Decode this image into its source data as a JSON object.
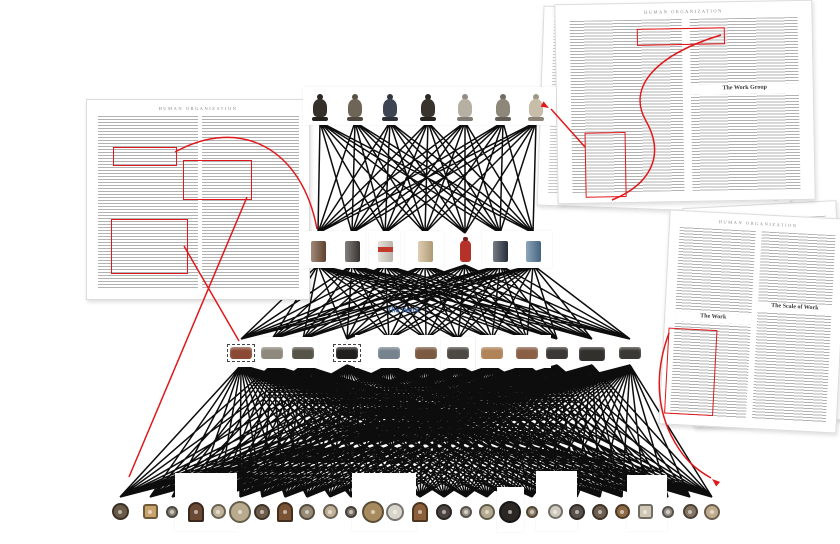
{
  "canvas": {
    "width": 840,
    "height": 544,
    "bg": "#ffffff",
    "line_color": "#0d0d0d",
    "annotation_red": "#e0181b",
    "label_blue": "#3b66a8"
  },
  "center_label": {
    "text": "The Work",
    "x": 403,
    "y": 311
  },
  "pages": {
    "left": {
      "x": 86,
      "y": 99,
      "w": 222,
      "h": 199,
      "rotate": 0,
      "running_head": "HUMAN ORGANIZATION",
      "red_boxes": [
        {
          "x": 26,
          "y": 47,
          "w": 62,
          "h": 17
        },
        {
          "x": 96,
          "y": 60,
          "w": 67,
          "h": 38
        },
        {
          "x": 24,
          "y": 119,
          "w": 75,
          "h": 53
        }
      ]
    },
    "top_right_back": {
      "x": 540,
      "y": 10,
      "w": 252,
      "h": 198,
      "rotate": 2
    },
    "top_right_front": {
      "x": 556,
      "y": 2,
      "w": 256,
      "h": 198,
      "rotate": -1,
      "running_head": "HUMAN ORGANIZATION",
      "heading": "The Work Group",
      "red_boxes": [
        {
          "x": 81,
          "y": 25,
          "w": 86,
          "h": 15
        },
        {
          "x": 27,
          "y": 128,
          "w": 39,
          "h": 63
        }
      ]
    },
    "right_back": {
      "x": 688,
      "y": 204,
      "w": 152,
      "h": 218,
      "rotate": -3
    },
    "right_front": {
      "x": 664,
      "y": 214,
      "w": 176,
      "h": 213,
      "rotate": 3,
      "running_head": "HUMAN ORGANIZATION",
      "heading_left": "The Work",
      "heading_right": "The Scale of Work",
      "red_boxes": [
        {
          "x": 4,
          "y": 117,
          "w": 47,
          "h": 84
        }
      ]
    }
  },
  "network": {
    "rows": [
      {
        "id": "figurines",
        "y_bot": 122,
        "y_top": 90,
        "item_top": 94,
        "nodes": [
          {
            "x": 320,
            "c": "#35302a"
          },
          {
            "x": 355,
            "c": "#6e6557"
          },
          {
            "x": 390,
            "c": "#3d4452"
          },
          {
            "x": 428,
            "c": "#38332c"
          },
          {
            "x": 465,
            "c": "#b6b0a3"
          },
          {
            "x": 503,
            "c": "#8d877a"
          },
          {
            "x": 536,
            "c": "#c7bda9"
          }
        ]
      },
      {
        "id": "containers",
        "y_top": 233,
        "y_bot": 265,
        "item_top": 241,
        "nodes": [
          {
            "x": 318,
            "c": "#6f4c34"
          },
          {
            "x": 352,
            "c": "#423c38"
          },
          {
            "x": 385,
            "c": "#d9d2c6",
            "accent": "#c23a2e"
          },
          {
            "x": 425,
            "c": "#cdb489"
          },
          {
            "x": 465,
            "c": "#b5322a",
            "t": "bottle"
          },
          {
            "x": 500,
            "c": "#2d3545"
          },
          {
            "x": 533,
            "c": "#507694"
          }
        ]
      },
      {
        "id": "stones",
        "y_top": 339,
        "y_bot": 365,
        "item_top": 347,
        "nodes": [
          {
            "x": 241,
            "c": "#8a4a35",
            "dashed": true
          },
          {
            "x": 272,
            "c": "#8f897d"
          },
          {
            "x": 303,
            "c": "#565349"
          },
          {
            "x": 347,
            "c": "#201f1d",
            "dashed": true
          },
          {
            "x": 389,
            "c": "#76838e"
          },
          {
            "x": 426,
            "c": "#7b5a41"
          },
          {
            "x": 458,
            "c": "#4c4843"
          },
          {
            "x": 492,
            "c": "#b08359"
          },
          {
            "x": 527,
            "c": "#8a5f46"
          },
          {
            "x": 557,
            "c": "#3a3734"
          },
          {
            "x": 592,
            "c": "#32302c",
            "big": true
          },
          {
            "x": 630,
            "c": "#3b3934"
          }
        ]
      },
      {
        "id": "clocks",
        "y_top": 497,
        "y_bot": 530,
        "center_y": 512,
        "nodes": [
          {
            "x": 120,
            "c": "#6a5a48",
            "s": 17
          },
          {
            "x": 150,
            "c": "#c8a36b",
            "s": 15,
            "t": "sq"
          },
          {
            "x": 172,
            "c": "#8a8274",
            "s": 12
          },
          {
            "x": 196,
            "c": "#6b4a35",
            "s": 16,
            "t": "m"
          },
          {
            "x": 218,
            "c": "#c2b49a",
            "s": 15
          },
          {
            "x": 240,
            "c": "#b8ab8e",
            "s": 22
          },
          {
            "x": 262,
            "c": "#6f5b49",
            "s": 16
          },
          {
            "x": 285,
            "c": "#7a5334",
            "s": 16,
            "t": "m"
          },
          {
            "x": 307,
            "c": "#988a74",
            "s": 16
          },
          {
            "x": 330,
            "c": "#c0b098",
            "s": 15
          },
          {
            "x": 351,
            "c": "#7d7266",
            "s": 12
          },
          {
            "x": 373,
            "c": "#a78b5f",
            "s": 22
          },
          {
            "x": 395,
            "c": "#d9d5cb",
            "s": 18
          },
          {
            "x": 420,
            "c": "#8a5f3a",
            "s": 16,
            "t": "m"
          },
          {
            "x": 444,
            "c": "#4a4340",
            "s": 16
          },
          {
            "x": 466,
            "c": "#9c9487",
            "s": 12
          },
          {
            "x": 487,
            "c": "#b5a98f",
            "s": 16
          },
          {
            "x": 510,
            "c": "#2a2724",
            "s": 22
          },
          {
            "x": 532,
            "c": "#8f7f66",
            "s": 12
          },
          {
            "x": 555,
            "c": "#cfc9bd",
            "s": 15
          },
          {
            "x": 577,
            "c": "#58504a",
            "s": 16
          },
          {
            "x": 600,
            "c": "#6e5f4e",
            "s": 16
          },
          {
            "x": 622,
            "c": "#8d6a45",
            "s": 15
          },
          {
            "x": 645,
            "c": "#cfc6b4",
            "s": 15,
            "t": "sq"
          },
          {
            "x": 668,
            "c": "#9a9288",
            "s": 12
          },
          {
            "x": 690,
            "c": "#857563",
            "s": 15
          },
          {
            "x": 712,
            "c": "#c3ab8d",
            "s": 16
          }
        ]
      }
    ],
    "cards": [
      {
        "x": 303,
        "y": 87,
        "w": 253,
        "h": 38
      },
      {
        "x": 299,
        "y": 231,
        "w": 66,
        "h": 37
      },
      {
        "x": 369,
        "y": 231,
        "w": 31,
        "h": 37
      },
      {
        "x": 405,
        "y": 231,
        "w": 39,
        "h": 37
      },
      {
        "x": 482,
        "y": 231,
        "w": 70,
        "h": 37
      },
      {
        "x": 231,
        "y": 340,
        "w": 21,
        "h": 27
      },
      {
        "x": 256,
        "y": 337,
        "w": 62,
        "h": 31
      },
      {
        "x": 355,
        "y": 335,
        "w": 79,
        "h": 33
      },
      {
        "x": 441,
        "y": 337,
        "w": 34,
        "h": 31
      },
      {
        "x": 476,
        "y": 335,
        "w": 75,
        "h": 33
      },
      {
        "x": 175,
        "y": 473,
        "w": 62,
        "h": 58
      },
      {
        "x": 352,
        "y": 473,
        "w": 64,
        "h": 58
      },
      {
        "x": 497,
        "y": 487,
        "w": 27,
        "h": 45
      },
      {
        "x": 536,
        "y": 471,
        "w": 41,
        "h": 60
      },
      {
        "x": 627,
        "y": 475,
        "w": 40,
        "h": 56
      }
    ]
  },
  "annotations": {
    "paths": [
      {
        "d": "M175,152 C240,116 302,148 317,229"
      },
      {
        "d": "M184,246 L239,341"
      },
      {
        "d": "M247,197 L129,477"
      },
      {
        "d": "M551,109 L585,147"
      },
      {
        "d": "M721,35 C658,54 626,86 646,121 C667,158 647,186 612,200"
      },
      {
        "d": "M669,333 C653,376 657,416 679,449 C689,464 699,471 711,478"
      }
    ],
    "arrows": [
      {
        "x": 549,
        "y": 108,
        "a": 210
      },
      {
        "x": 712,
        "y": 479,
        "a": 40
      }
    ]
  }
}
